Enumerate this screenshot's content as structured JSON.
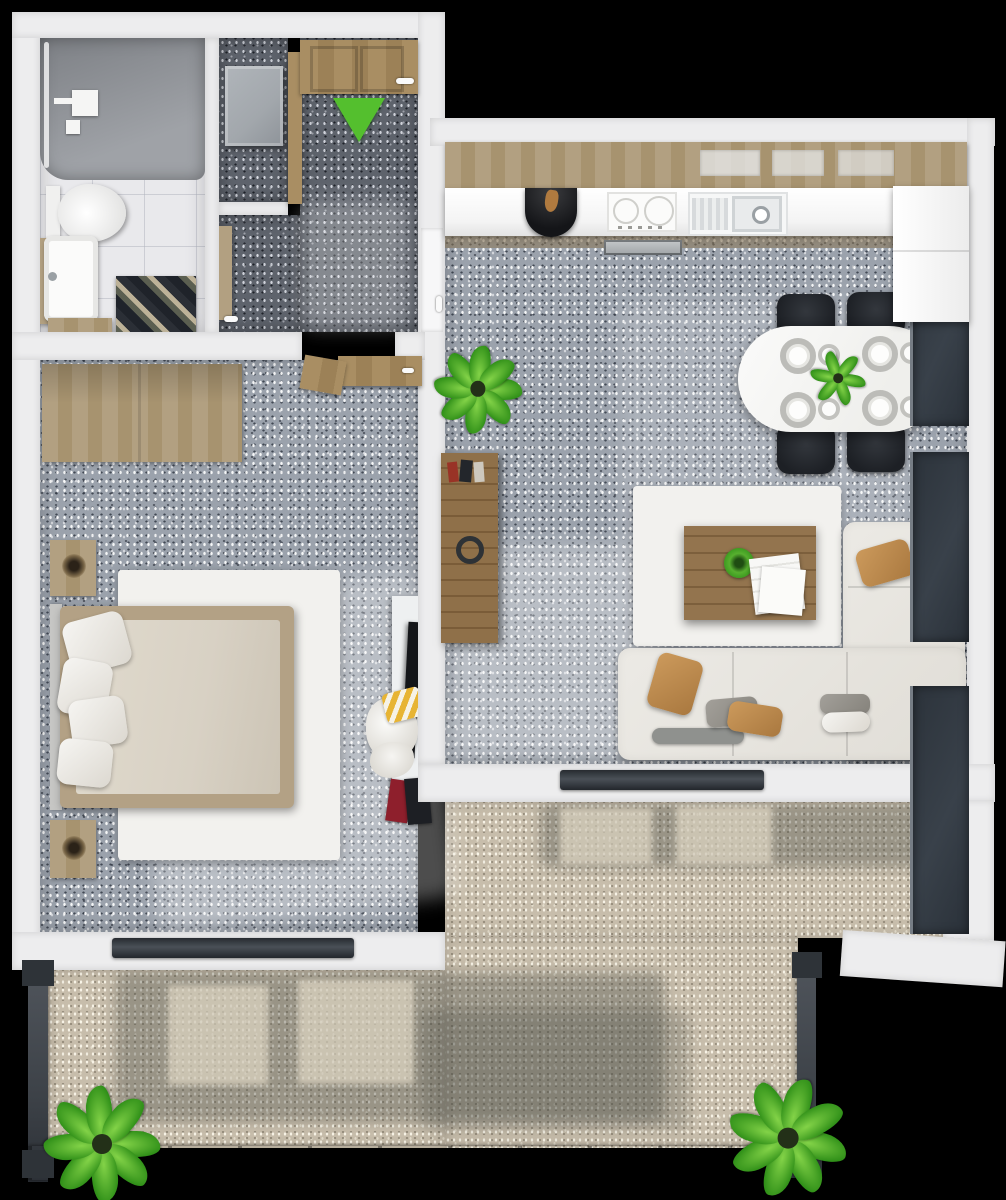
{
  "scene": {
    "kind": "3d-floor-plan-top-down-render",
    "visible_text": "none",
    "background": "#000000"
  },
  "palette": {
    "bg": "#000000",
    "wall": "#ededee",
    "carpet": "#9ba2ac",
    "carpetDark": "#5e636c",
    "beige": "#c7bdab",
    "marble": "#e9e9ec",
    "shower": "#979a9f",
    "wood": "#b2a081",
    "woodDoor": "#a98e63",
    "woodDark": "#8a6c49",
    "white": "#f5f5f4",
    "sofa": "#e0ddd6",
    "cushionTan": "#a9783f",
    "chair": "#1d2025",
    "railing": "#3d4248",
    "glass": "#39414a",
    "green": "#54bf2e",
    "green2": "#2f8f18",
    "greyCabinet": "#a2a7ac",
    "tv": "#141619",
    "rug": "#f2f1ee",
    "blanket": "#d8d1c4",
    "bedFrame": "#b3a185",
    "headboard": "#c6c6c4",
    "counter": "#f4f4f4"
  },
  "marker": {
    "entrance_arrow": {
      "shape": "triangle-down",
      "color": "#54bf2e"
    }
  },
  "rooms": [
    {
      "name": "bathroom",
      "items": [
        "walk-in-shower",
        "shower-fixture",
        "toilet",
        "sink-vanity",
        "wood-shelf",
        "patterned-bath-rug"
      ]
    },
    {
      "name": "entry-hall",
      "items": [
        "entrance-door",
        "entrance-arrow-marker",
        "closet-cabinet",
        "storage-nook",
        "bedroom-door-open",
        "living-room-door"
      ]
    },
    {
      "name": "bedroom",
      "items": [
        "wardrobe",
        "double-bed",
        "headboard",
        "pillows-x4",
        "nightstand-top",
        "nightstand-bottom",
        "table-lamps",
        "white-area-rug",
        "tv-panel",
        "clothes-pile",
        "books-stack"
      ]
    },
    {
      "name": "kitchen-living",
      "items": [
        "upper-cabinets",
        "countertop",
        "black-round-basin",
        "induction-cooktop",
        "oven",
        "kitchen-sink",
        "tall-cabinet-column",
        "dining-table",
        "dining-chairs-x4",
        "place-settings-x4",
        "centerpiece-plant",
        "floor-plant",
        "wood-sideboard",
        "decor-ring",
        "books",
        "white-area-rug",
        "coffee-table",
        "coffee-table-plant",
        "magazines",
        "corner-sofa",
        "cushions",
        "floor-to-ceiling-windows"
      ]
    },
    {
      "name": "balcony-terrace",
      "items": [
        "sliding-door-living",
        "sliding-door-bedroom",
        "railing-left",
        "railing-bottom",
        "railing-right",
        "potted-plant-left",
        "potted-plant-right",
        "sun-shadow-patches"
      ]
    }
  ]
}
